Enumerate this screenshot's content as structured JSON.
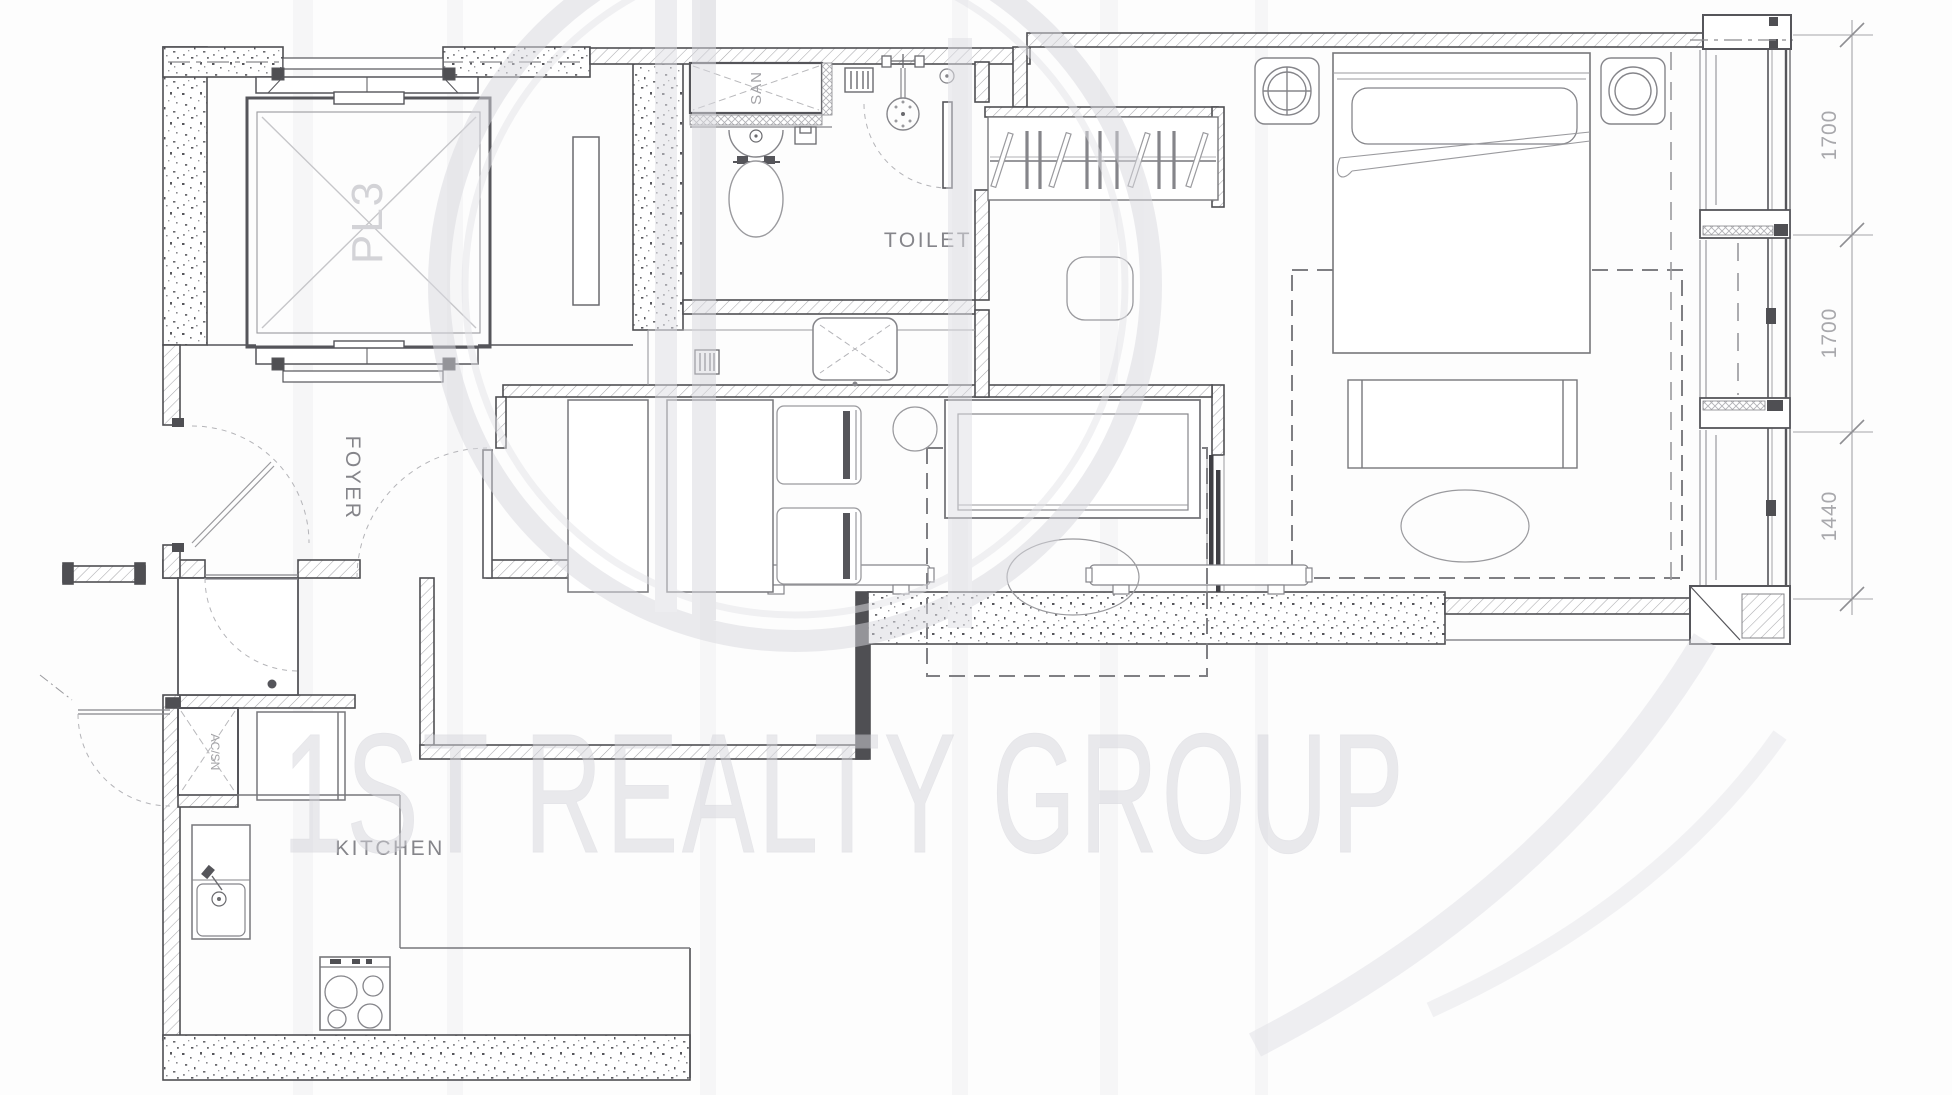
{
  "drawing": {
    "type": "apartment floor plan",
    "watermark": {
      "text": "1ST REALTY GROUP"
    },
    "labels": {
      "elevator_shaft": "PL3",
      "sanitary_shaft": "SAN",
      "toilet_room": "TOILET",
      "foyer": "FOYER",
      "ac_shaft": "AC/SN",
      "kitchen": "KITCHEN"
    },
    "dimensions": [
      {
        "value": "1700"
      },
      {
        "value": "1700"
      },
      {
        "value": "1440"
      }
    ],
    "colors": {
      "wall_line": "#4f4f53",
      "furniture_line": "#85858a",
      "light_line": "#a8a8ac",
      "watermark": "#dcdce2",
      "background": "#fdfdfd"
    }
  }
}
